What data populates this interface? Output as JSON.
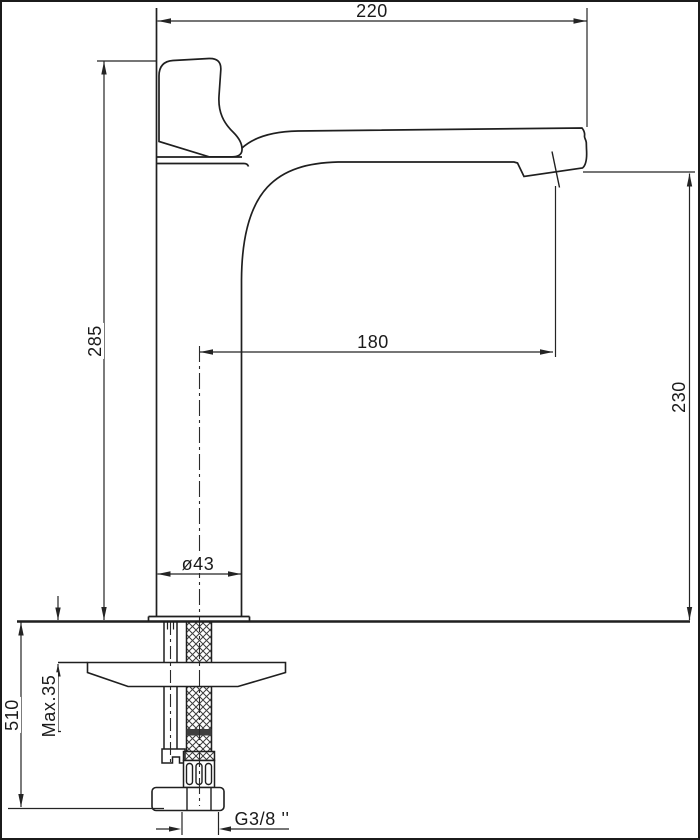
{
  "drawing": {
    "subject": "tall single-lever basin mixer faucet, side elevation with installation dimensions",
    "units_implied": "mm",
    "dimensions": {
      "overall_width": "220",
      "body_height": "285",
      "spout_reach": "180",
      "spout_outlet_height": "230",
      "base_diameter": "ø43",
      "max_mounting_thickness": "Max.35",
      "below_deck_length": "510",
      "connection_thread": "G3/8 ''"
    },
    "line_color": "#1f1f1f"
  }
}
